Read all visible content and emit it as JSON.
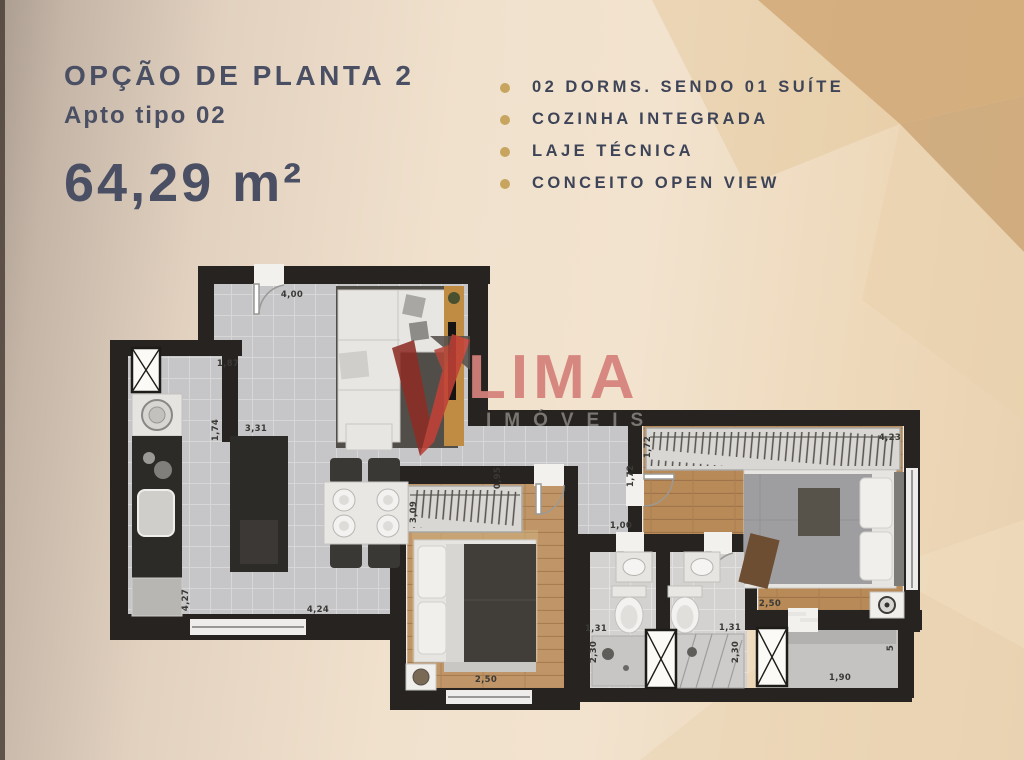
{
  "header": {
    "title": "OPÇÃO DE PLANTA 2",
    "subtitle": "Apto tipo 02",
    "area": "64,29 m²"
  },
  "features": {
    "items": [
      {
        "label": "02 DORMS. SENDO 01 SUÍTE"
      },
      {
        "label": "COZINHA INTEGRADA"
      },
      {
        "label": "LAJE TÉCNICA"
      },
      {
        "label": "CONCEITO OPEN VIEW"
      }
    ]
  },
  "watermark": {
    "brand": "LIMA",
    "subbrand": "IMÓVEIS"
  },
  "floorplan": {
    "dimensions": [
      {
        "text": "4,00",
        "x": 292,
        "y": 297,
        "rot": 0
      },
      {
        "text": "1,87",
        "x": 228,
        "y": 366,
        "rot": 0
      },
      {
        "text": "1,74",
        "x": 218,
        "y": 430,
        "rot": 90
      },
      {
        "text": "3,31",
        "x": 256,
        "y": 431,
        "rot": 0
      },
      {
        "text": "4,27",
        "x": 188,
        "y": 600,
        "rot": 90
      },
      {
        "text": "4,24",
        "x": 318,
        "y": 612,
        "rot": 0
      },
      {
        "text": "0,95",
        "x": 500,
        "y": 478,
        "rot": 90
      },
      {
        "text": "3,09",
        "x": 416,
        "y": 512,
        "rot": 90
      },
      {
        "text": "2,50",
        "x": 486,
        "y": 682,
        "rot": 0
      },
      {
        "text": "1,00",
        "x": 621,
        "y": 528,
        "rot": 0
      },
      {
        "text": "1,72",
        "x": 633,
        "y": 476,
        "rot": 90
      },
      {
        "text": "1,72",
        "x": 650,
        "y": 447,
        "rot": 90
      },
      {
        "text": "4,23",
        "x": 890,
        "y": 440,
        "rot": 0
      },
      {
        "text": "2,50",
        "x": 770,
        "y": 606,
        "rot": 0
      },
      {
        "text": "1,31",
        "x": 596,
        "y": 631,
        "rot": 0
      },
      {
        "text": "2,30",
        "x": 596,
        "y": 652,
        "rot": 90
      },
      {
        "text": "1,31",
        "x": 730,
        "y": 630,
        "rot": 0
      },
      {
        "text": "2,30",
        "x": 738,
        "y": 652,
        "rot": 90
      },
      {
        "text": "1,90",
        "x": 840,
        "y": 680,
        "rot": 0
      },
      {
        "text": "5",
        "x": 893,
        "y": 648,
        "rot": 90
      }
    ]
  },
  "colors": {
    "accent_bullet": "#c8a55f",
    "title_text": "#4a4f64",
    "brand_red": "#c24136",
    "brand_salmon": "#d5827b",
    "tan_shape": "#d2aa7a"
  }
}
